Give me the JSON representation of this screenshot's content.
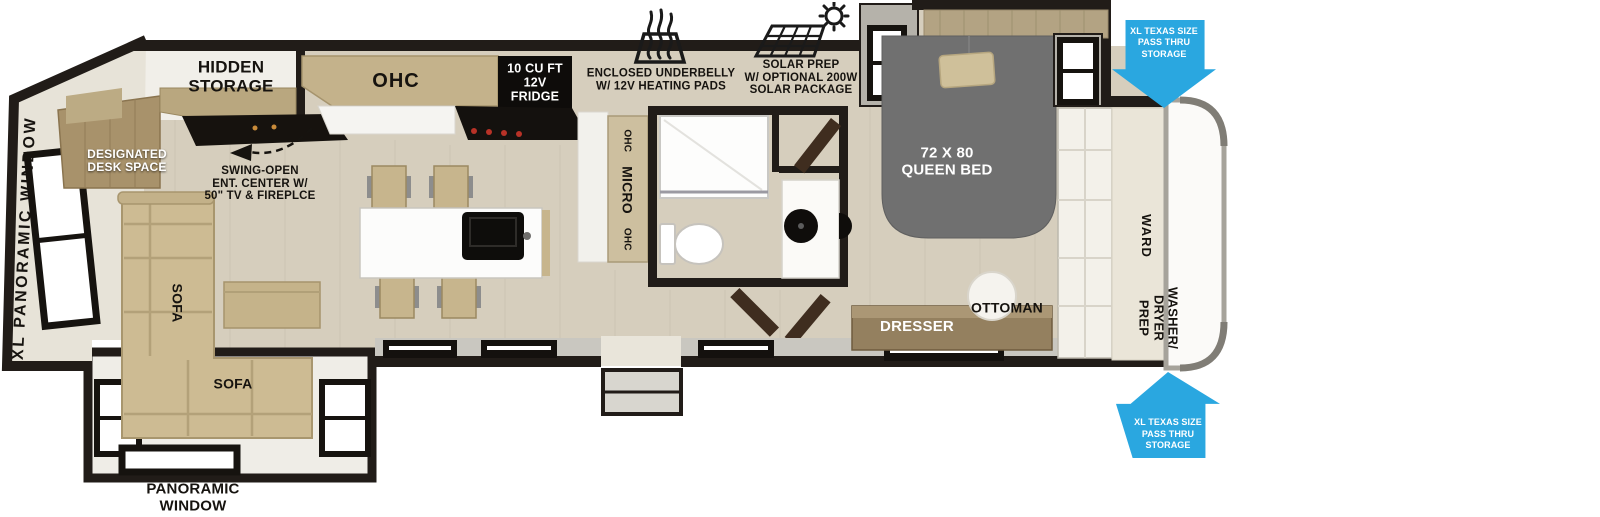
{
  "plan": {
    "living": {
      "xl_panoramic_window": "XL PANORAMIC WINDOW",
      "panoramic_window": "PANORAMIC\nWINDOW",
      "sofa_side": "SOFA",
      "sofa_front": "SOFA",
      "designated_desk_space": "DESIGNATED\nDESK SPACE",
      "hidden_storage": "HIDDEN\nSTORAGE",
      "ent_center": "SWING-OPEN\nENT. CENTER W/\n50\" TV & FIREPLCE"
    },
    "kitchen": {
      "ohc": "OHC",
      "fridge": "10 CU FT\n12V\nFRIDGE",
      "pantry_top": "OHC",
      "pantry_mid": "MICRO",
      "pantry_bottom": "OHC"
    },
    "callouts": {
      "underbelly": "ENCLOSED UNDERBELLY\nW/ 12V HEATING PADS",
      "solar": "SOLAR PREP\nW/ OPTIONAL 200W\nSOLAR PACKAGE",
      "pass_thru_top": "XL TEXAS SIZE\nPASS THRU\nSTORAGE",
      "pass_thru_bottom": "XL TEXAS SIZE\nPASS THRU\nSTORAGE"
    },
    "bedroom": {
      "queen_bed": "72 X 80\nQUEEN BED",
      "dresser": "DRESSER",
      "ottoman": "OTTOMAN",
      "ward": "WARD",
      "washer_dryer_prep": "WASHER/\nDRYER\nPREP"
    },
    "colors": {
      "accent_blue": "#2aa7e0",
      "wall": "#211c18",
      "floor": "#d6cebd",
      "bed_gray": "#707070",
      "wood": "#c4b28b"
    }
  }
}
